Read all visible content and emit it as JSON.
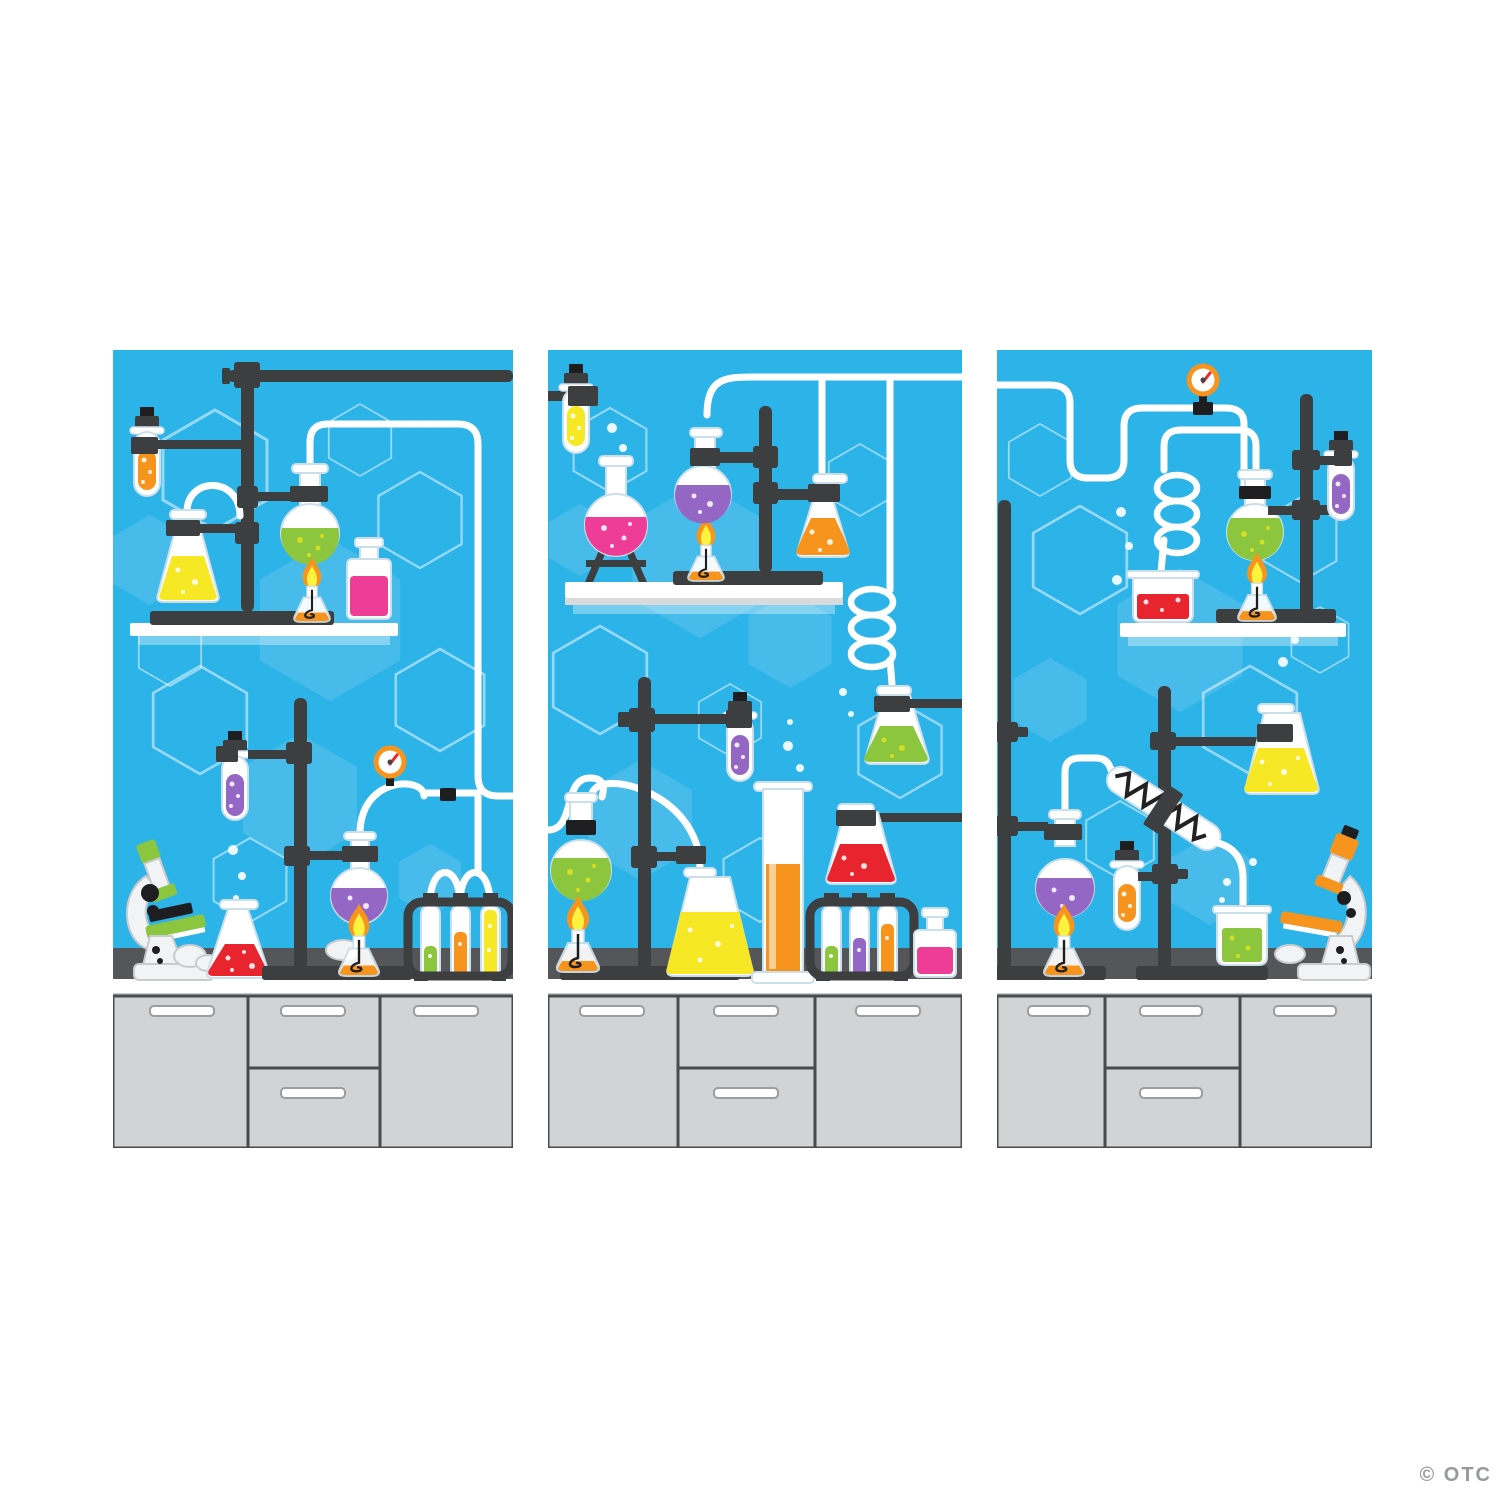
{
  "page": {
    "background": "#FFFFFF",
    "watermark": "© OTC",
    "description": "Three-panel science lab backdrop illustration: blue hexagon-pattern walls, chemistry glassware on stands and shelves, gray lab benches with cabinets"
  },
  "colors": {
    "panel_bg": "#2CB3E8",
    "hex_stroke": "rgba(255,255,255,0.5)",
    "hex_fill": "rgba(255,255,255,0.13)",
    "bench": "#55565A",
    "counter": "#FFFFFF",
    "counter_shadow": "#C8CACC",
    "cabinet": "#D2D3D5",
    "cabinet_line": "#4A4B4D",
    "handle_edge": "#9A9C9E",
    "metal": "#3D3E40",
    "metal_dark": "#1E1E20",
    "glass_edge": "#CBDFEA",
    "tube": "#FFFFFF",
    "liquid_orange": "#F7941E",
    "liquid_yellow": "#F6E824",
    "liquid_green": "#8CC63E",
    "liquid_purple": "#9467C4",
    "liquid_red": "#E8252E",
    "liquid_pink": "#EE3D96",
    "dot_yellow": "#D7DF23",
    "flame_outer": "#F7941E",
    "flame_inner": "#FFF23F",
    "gauge_ring": "#F7941E",
    "gauge_needle": "#E8252E",
    "scope_green": "#8CC63E",
    "scope_orange": "#F7941E",
    "scope_body": "#F2F3F4",
    "scope_gray": "#C9CBCD",
    "shelf_shadow": "rgba(255,255,255,0.35)",
    "watermark_color": "#97999C"
  },
  "panels": [
    {
      "id": "left",
      "equipment": [
        "ring stand with crossbar",
        "orange test tube",
        "yellow erlenmeyer flask",
        "green round-bottom flask",
        "alcohol burner",
        "pink reagent bottle",
        "wall shelf",
        "green microscope",
        "red erlenmeyer flask",
        "purple test tube",
        "purple round-bottom flask",
        "pressure gauge",
        "rack with green, orange and yellow test tubes",
        "lab bench",
        "cabinet with two doors and two drawers"
      ]
    },
    {
      "id": "middle",
      "equipment": [
        "clamped yellow test tube",
        "pink round-bottom flask on tripod",
        "two alcohol burners",
        "purple round-bottom flask",
        "orange erlenmeyer flask",
        "spiral condenser tube",
        "green erlenmeyer flask",
        "green round-bottom flask",
        "yellow erlenmeyer flask",
        "graduated cylinder with orange liquid",
        "red erlenmeyer flask",
        "rack with green, purple and orange test tubes",
        "pink reagent bottle",
        "wall shelf",
        "lab bench",
        "cabinet with two doors and two drawers"
      ]
    },
    {
      "id": "right",
      "equipment": [
        "pressure gauge",
        "spiral condenser tube",
        "red beaker",
        "green round-bottom flask",
        "two alcohol burners",
        "purple test tube",
        "wall shelf",
        "two tall lab stands",
        "purple round-bottom flask",
        "orange test tube",
        "liebig condenser",
        "green beaker",
        "yellow erlenmeyer flask",
        "orange microscope",
        "lab bench",
        "cabinet with two doors and two drawers"
      ]
    }
  ]
}
